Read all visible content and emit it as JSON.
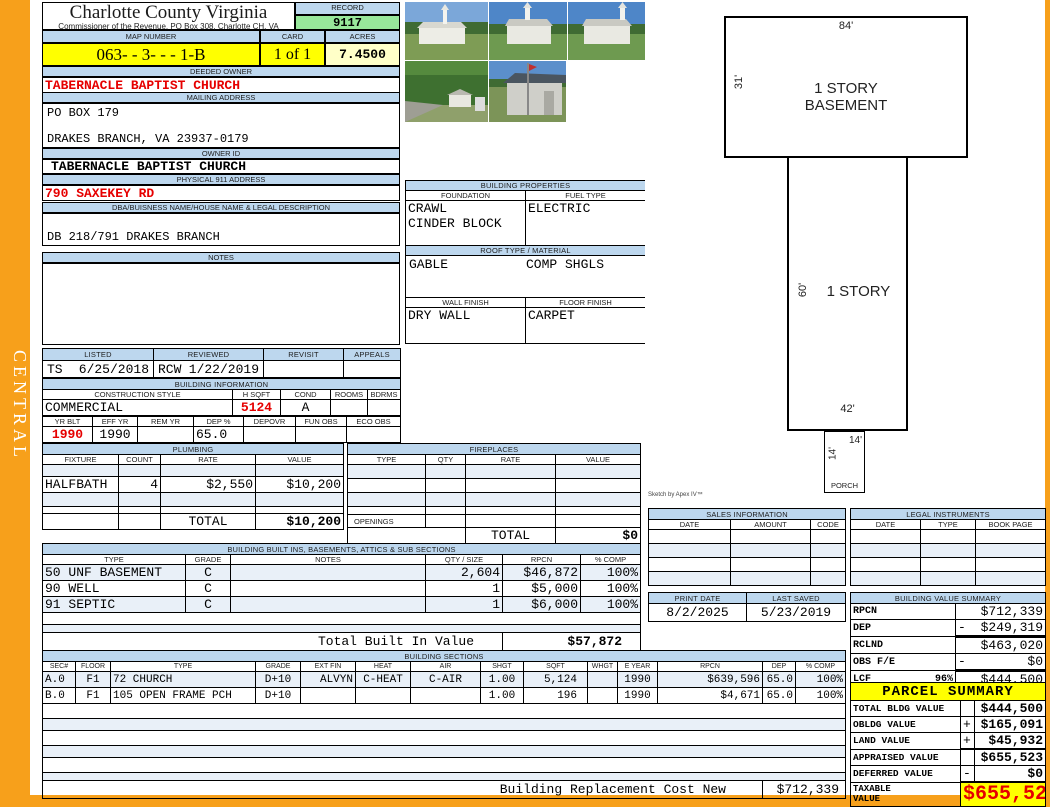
{
  "colors": {
    "orange": "#F7A01B",
    "band_blue": "#BDD7EE",
    "record_green": "#98E79B",
    "yellow": "#FFFF00",
    "pale_yellow": "#FFFFC8",
    "red": "#E60000"
  },
  "region_tab": "CENTRAL",
  "header": {
    "county": "Charlotte County Virginia",
    "commissioner": "Commissioner of the Revenue, PO Box 308, Charlotte CH, VA",
    "record_label": "RECORD",
    "record": "9117",
    "map_label": "MAP NUMBER",
    "map_number": "063- - 3- -  -  1-B",
    "card_label": "CARD",
    "card": "1 of 1",
    "acres_label": "ACRES",
    "acres": "7.4500"
  },
  "owner": {
    "deeded_label": "DEEDED OWNER",
    "deeded": "TABERNACLE BAPTIST CHURCH",
    "mailing_label": "MAILING ADDRESS",
    "mailing_line1": "PO BOX 179",
    "mailing_line2": "DRAKES BRANCH, VA 23937-0179",
    "owner_id_label": "OWNER ID",
    "owner_id": "TABERNACLE BAPTIST CHURCH",
    "addr911_label": "PHYSICAL 911 ADDRESS",
    "addr911": "790 SAXEKEY RD",
    "dba_label": "DBA/BUISNESS NAME/HOUSE NAME  & LEGAL DESCRIPTION",
    "dba": "DB 218/791 DRAKES BRANCH",
    "notes_label": "NOTES",
    "notes": ""
  },
  "review": {
    "listed_label": "LISTED",
    "listed_by": "TS",
    "listed_date": "6/25/2018",
    "reviewed_label": "REVIEWED",
    "reviewed_by": "RCW",
    "reviewed_date": "1/22/2019",
    "revisit_label": "REVISIT",
    "revisit": "",
    "appeals_label": "APPEALS",
    "appeals": ""
  },
  "building_information": {
    "title": "BUILDING INFORMATION",
    "construction_style_label": "CONSTRUCTION STYLE",
    "construction_style": "COMMERCIAL",
    "h_sqft_label": "H SQFT",
    "h_sqft": "5124",
    "cond_label": "COND",
    "cond": "A",
    "rooms_label": "ROOMS",
    "rooms": "",
    "bdrms_label": "BDRMS",
    "bdrms": "",
    "yr_blt_label": "YR BLT",
    "yr_blt": "1990",
    "eff_yr_label": "EFF YR",
    "eff_yr": "1990",
    "rem_yr_label": "REM YR",
    "rem_yr": "",
    "dep_label": "DEP %",
    "dep": "65.0",
    "depovr_label": "DEPOVR",
    "depovr": "",
    "fun_obs_label": "FUN OBS",
    "fun_obs": "",
    "eco_obs_label": "ECO OBS",
    "eco_obs": ""
  },
  "building_properties": {
    "title": "BUILDING PROPERTIES",
    "foundation_label": "FOUNDATION",
    "foundation_line1": "CRAWL",
    "foundation_line2": "CINDER BLOCK",
    "fuel_label": "FUEL TYPE",
    "fuel": "ELECTRIC",
    "roof_label": "ROOF TYPE / MATERIAL",
    "roof_type": "GABLE",
    "roof_material": "COMP SHGLS",
    "wall_label": "WALL FINISH",
    "wall": "DRY WALL",
    "floor_label": "FLOOR FINISH",
    "floor": "CARPET"
  },
  "plumbing": {
    "title": "PLUMBING",
    "col_fixture": "FIXTURE",
    "col_count": "COUNT",
    "col_rate": "RATE",
    "col_value": "VALUE",
    "rows": [
      {
        "fixture": "HALFBATH",
        "count": "4",
        "rate": "$2,550",
        "value": "$10,200"
      }
    ],
    "total_label": "TOTAL",
    "total": "$10,200"
  },
  "fireplaces": {
    "title": "FIREPLACES",
    "col_type": "TYPE",
    "col_qty": "QTY",
    "col_rate": "RATE",
    "col_value": "VALUE",
    "openings_label": "OPENINGS",
    "total_label": "TOTAL",
    "total": "$0"
  },
  "built_ins": {
    "title": "BUILDING BUILT INS, BASEMENTS,  ATTICS & SUB SECTIONS",
    "col_type": "TYPE",
    "col_grade": "GRADE",
    "col_notes": "NOTES",
    "col_qty": "QTY / SIZE",
    "col_rpcn": "RPCN",
    "col_comp": "% COMP",
    "rows": [
      {
        "type": "50 UNF BASEMENT",
        "grade": "C",
        "notes": "",
        "qty": "2,604",
        "rpcn": "$46,872",
        "comp": "100%"
      },
      {
        "type": "90 WELL",
        "grade": "C",
        "notes": "",
        "qty": "1",
        "rpcn": "$5,000",
        "comp": "100%"
      },
      {
        "type": "91 SEPTIC",
        "grade": "C",
        "notes": "",
        "qty": "1",
        "rpcn": "$6,000",
        "comp": "100%"
      }
    ],
    "total_label": "Total Built In Value",
    "total": "$57,872"
  },
  "building_sections": {
    "title": "BUILDING SECTIONS",
    "col_sec": "SEC#",
    "col_floor": "FLOOR",
    "col_type": "TYPE",
    "col_grade": "GRADE",
    "col_ext": "EXT FIN",
    "col_heat": "HEAT",
    "col_air": "AIR",
    "col_shgt": "SHGT",
    "col_sqft": "SQFT",
    "col_whgt": "WHGT",
    "col_eyear": "E YEAR",
    "col_rpcn": "RPCN",
    "col_dep": "DEP",
    "col_comp": "% COMP",
    "rows": [
      {
        "sec": "A.0",
        "floor": "F1",
        "type": "72 CHURCH",
        "grade": "D+10",
        "ext_fin": "ALVYN",
        "heat": "C-HEAT",
        "air": "C-AIR",
        "shgt": "1.00",
        "sqft": "5,124",
        "whgt": "",
        "e_year": "1990",
        "rpcn": "$639,596",
        "dep": "65.0",
        "comp": "100%"
      },
      {
        "sec": "B.0",
        "floor": "F1",
        "type": "105 OPEN FRAME PCH",
        "grade": "D+10",
        "ext_fin": "",
        "heat": "",
        "air": "",
        "shgt": "1.00",
        "sqft": "196",
        "whgt": "",
        "e_year": "1990",
        "rpcn": "$4,671",
        "dep": "65.0",
        "comp": "100%"
      }
    ],
    "replacement_label": "Building Replacement Cost New",
    "replacement_value": "$712,339"
  },
  "sales_information": {
    "title": "SALES INFORMATION",
    "col_date": "DATE",
    "col_amount": "AMOUNT",
    "col_code": "CODE"
  },
  "legal_instruments": {
    "title": "LEGAL INSTRUMENTS",
    "col_date": "DATE",
    "col_type": "TYPE",
    "col_book": "BOOK PAGE"
  },
  "dates": {
    "print_label": "PRINT DATE",
    "print_date": "8/2/2025",
    "saved_label": "LAST SAVED",
    "saved_date": "5/23/2019"
  },
  "building_value_summary": {
    "title": "BUILDING VALUE SUMMARY",
    "rpcn_label": "RPCN",
    "rpcn": "$712,339",
    "dep_label": "DEP",
    "dep_sign": "-",
    "dep": "$249,319",
    "rclnd_label": "RCLND",
    "rclnd": "$463,020",
    "obs_label": "OBS F/E",
    "obs_sign": "-",
    "obs": "$0",
    "lcf_label": "LCF",
    "lcf_pct": "96%",
    "lcf": "$444,500"
  },
  "parcel_summary": {
    "title": "PARCEL SUMMARY",
    "rows": [
      {
        "label": "TOTAL BLDG VALUE",
        "sign": "",
        "value": "$444,500"
      },
      {
        "label": "OBLDG VALUE",
        "sign": "+",
        "value": "$165,091"
      },
      {
        "label": "LAND VALUE",
        "sign": "+",
        "value": "$45,932"
      },
      {
        "label": "APPRAISED VALUE",
        "sign": "",
        "value": "$655,523"
      },
      {
        "label": "DEFERRED VALUE",
        "sign": "-",
        "value": "$0"
      }
    ],
    "taxable_label_line1": "TAXABLE",
    "taxable_label_line2": "VALUE",
    "taxable": "$655,523"
  },
  "sketch": {
    "credit": "Sketch by Apex IV™",
    "basement_label_line1": "1 STORY",
    "basement_label_line2": "BASEMENT",
    "basement_top": "84'",
    "basement_left": "31'",
    "story_label": "1 STORY",
    "story_left": "60'",
    "story_bottom": "42'",
    "porch_label": "PORCH",
    "porch_left": "14'",
    "porch_top": "14'"
  }
}
